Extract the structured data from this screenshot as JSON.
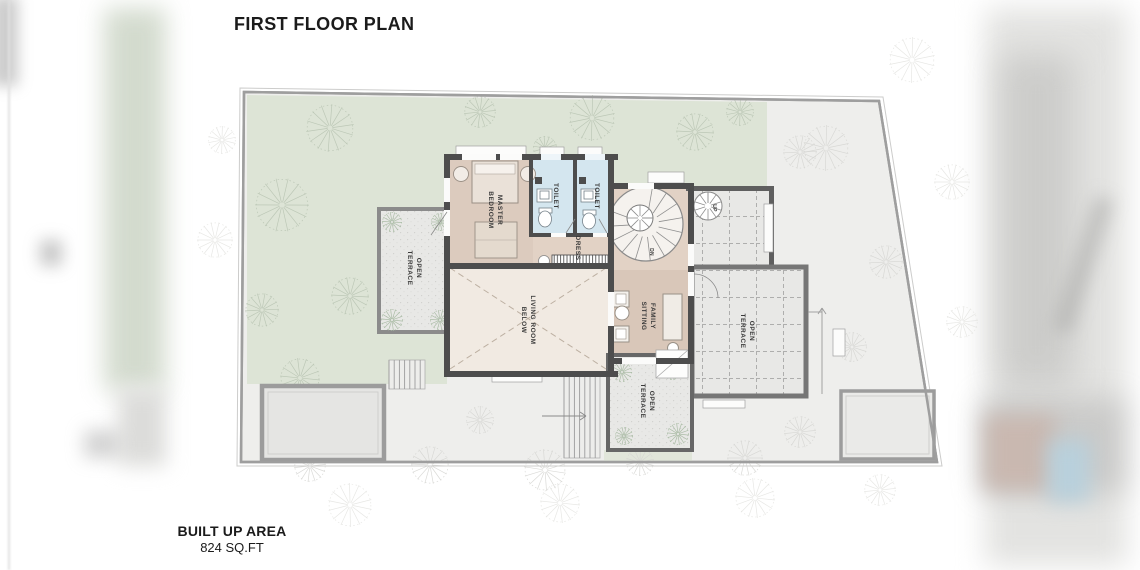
{
  "labels": {
    "title": "FIRST FLOOR PLAN",
    "built_up_area": "BUILT UP AREA",
    "area_value": "824 SQ.FT",
    "master_bedroom": [
      "MASTER",
      "BEDROOM"
    ],
    "toilet": "TOILET",
    "dress": "DRESS",
    "down": "DN",
    "up": "UP",
    "living_room_below": [
      "LIVING ROOM",
      "BELOW"
    ],
    "family_sitting": [
      "FAMILY",
      "SITTING"
    ],
    "open_terrace": [
      "OPEN",
      "TERRACE"
    ]
  },
  "colors": {
    "lawn": "#dde4d6",
    "paving": "#eeeeec",
    "wall": "#4d4d4d",
    "wood": "#dccbbe",
    "wood_light": "#e2d2c5",
    "toilet": "#d4e6ef",
    "living": "#f1eae2",
    "terrace": "#e8e8e6",
    "boundary": "#9e9e9e"
  }
}
